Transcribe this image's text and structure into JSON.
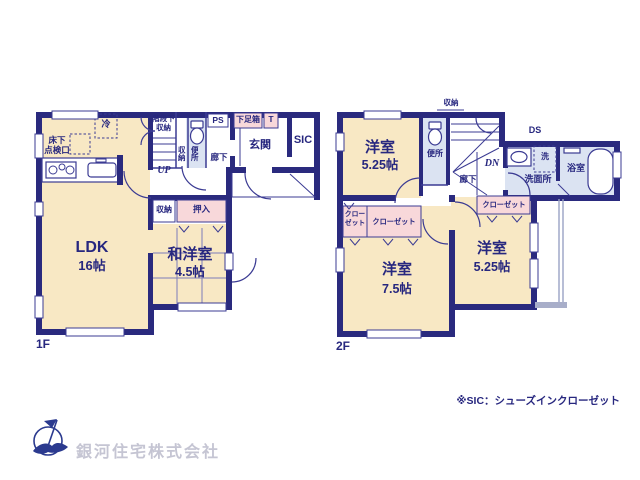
{
  "f1": {
    "floor": "1F",
    "rei": "冷",
    "yukashita1": "床下",
    "yukashita2": "点検口",
    "kaidan1": "階段下",
    "kaidan2": "収納",
    "up": "UP",
    "shuno_v": "収納",
    "benjo_v": "便所",
    "ps": "PS",
    "rouka": "廊下",
    "getabako": "下足箱",
    "t": "T",
    "genkan": "玄関",
    "sic": "SIC",
    "shuno": "収納",
    "oshiire": "押入",
    "ldk": "LDK",
    "ldk_size": "16帖",
    "washitsu": "和洋室",
    "washitsu_size": "4.5帖"
  },
  "f2": {
    "floor": "2F",
    "shuno": "収納",
    "benjo": "便所",
    "dn": "DN",
    "rouka": "廊下",
    "ds": "DS",
    "sen": "洗",
    "senmenjo": "洗面所",
    "yokushitsu": "浴室",
    "room_a": "洋室",
    "room_a_size": "5.25帖",
    "room_b": "洋室",
    "room_b_size": "7.5帖",
    "room_c": "洋室",
    "room_c_size": "5.25帖",
    "closet_a": "クローゼット",
    "closet_b1": "クロー",
    "closet_b2": "ゼット",
    "closet_c": "クローゼット"
  },
  "footer": {
    "company": "銀河住宅株式会社",
    "note": "※SIC：シューズインクローゼット"
  },
  "colors": {
    "wall": "#2a2a7e",
    "line": "#3b3b93",
    "room_cream": "#f8e8c4",
    "closet_pink": "#f8d8da",
    "wet_blue": "#dbe3f2",
    "text_navy": "#27277f",
    "company_gray": "#c5c5d3"
  }
}
